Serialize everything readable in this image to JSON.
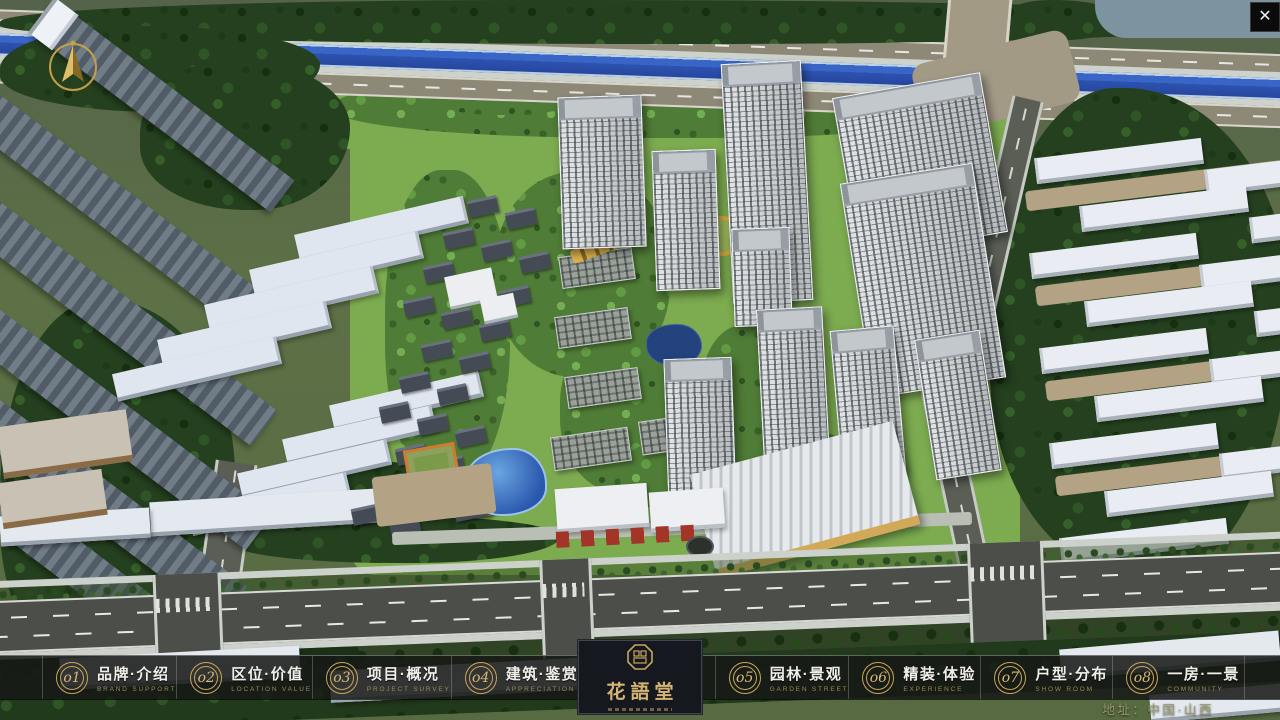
{
  "window": {
    "close_glyph": "✕"
  },
  "logo": {
    "title": "花語堂"
  },
  "nav": {
    "items": [
      {
        "num": "o1",
        "zh": "品牌·介绍",
        "en": "BRAND SUPPORT"
      },
      {
        "num": "o2",
        "zh": "区位·价值",
        "en": "LOCATION VALUE"
      },
      {
        "num": "o3",
        "zh": "项目·概况",
        "en": "PROJECT SURVEY"
      },
      {
        "num": "o4",
        "zh": "建筑·鉴赏",
        "en": "APPRECIATION"
      },
      {
        "num": "o5",
        "zh": "园林·景观",
        "en": "GARDEN STREET"
      },
      {
        "num": "o6",
        "zh": "精装·体验",
        "en": "EXPERIENCE"
      },
      {
        "num": "o7",
        "zh": "户型·分布",
        "en": "SHOW ROOM"
      },
      {
        "num": "o8",
        "zh": "一房·一景",
        "en": "COMMUNITY"
      }
    ]
  },
  "footer": {
    "address": "地址：中国·山西"
  },
  "colors": {
    "gold": "#c9a55e",
    "bar_bg": "rgba(22,25,22,0.87)",
    "river_blue": "#2c53b0",
    "gate_red": "#a23428",
    "lawn_green": "#7cab50"
  }
}
